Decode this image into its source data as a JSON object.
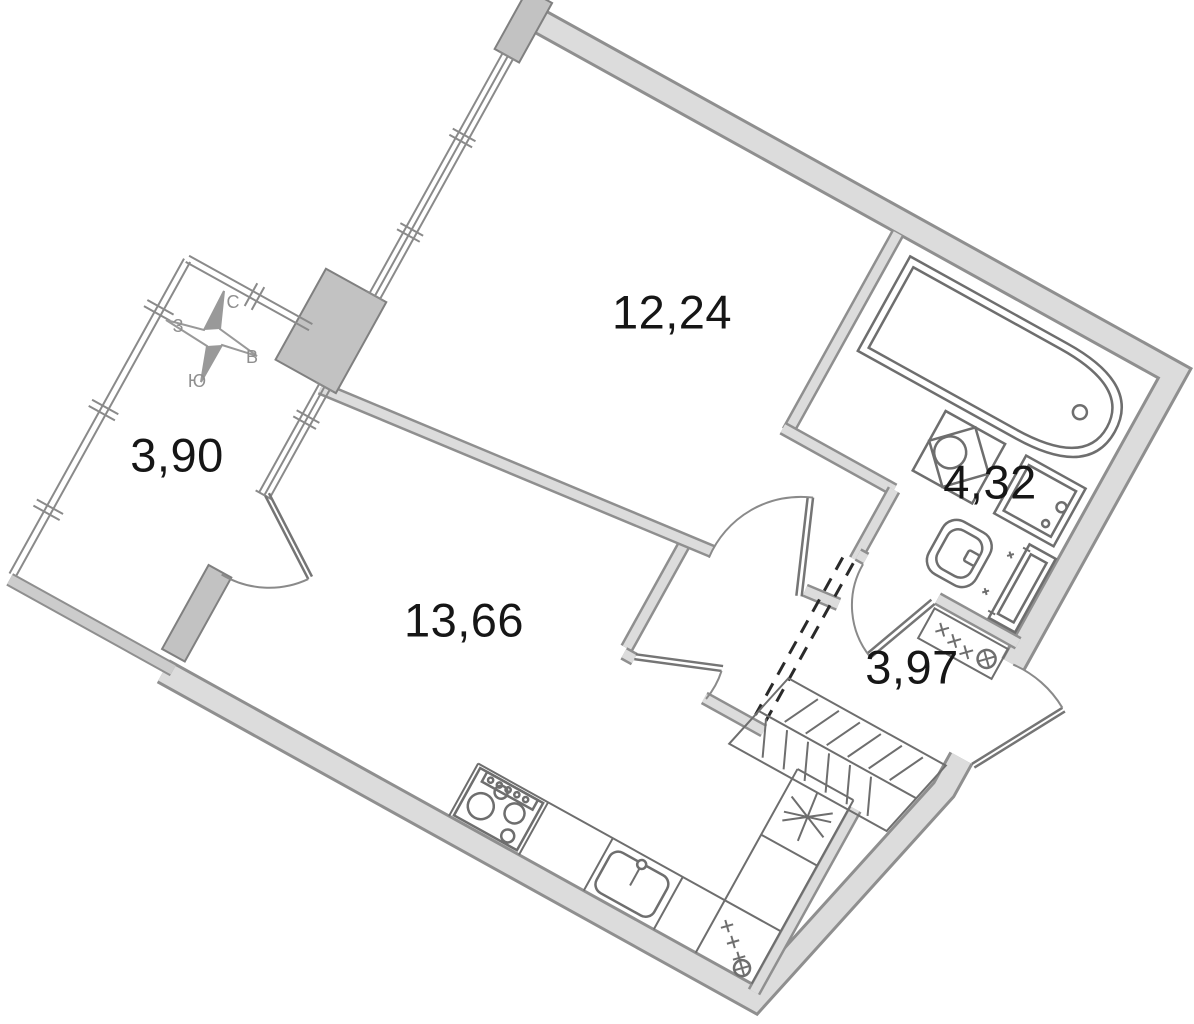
{
  "plan": {
    "title": "apartment-floor-plan",
    "rooms": [
      {
        "id": "bedroom",
        "area": "12,24"
      },
      {
        "id": "living-kitchen",
        "area": "13,66"
      },
      {
        "id": "bathroom",
        "area": "4,32"
      },
      {
        "id": "hallway",
        "area": "3,97"
      },
      {
        "id": "balcony",
        "area": "3,90"
      }
    ],
    "compass": {
      "north": "С",
      "south": "Ю",
      "west": "З",
      "east": "В"
    },
    "fixtures": [
      "bathtub-icon",
      "washing-machine-icon",
      "bath-sink-icon",
      "toilet-icon",
      "towel-radiator-icon",
      "vent-shaft-icon",
      "stove-icon",
      "kitchen-sink-icon",
      "kitchen-counter",
      "fridge-asterisk-icon",
      "wardrobe-hatched",
      "entry-door",
      "balcony-door",
      "bedroom-door",
      "bathroom-door",
      "hall-door",
      "compass-rose-icon"
    ],
    "colors": {
      "wall_fill": "#dcdcdc",
      "wall_edge": "#8f8f8f",
      "pillar_fill": "#c2c2c2",
      "fixture_stroke": "#6e6e6e",
      "dashed_line": "#2a2a2a",
      "label_text": "#161616",
      "compass_text": "#8f8f8f",
      "background": "#ffffff"
    }
  }
}
